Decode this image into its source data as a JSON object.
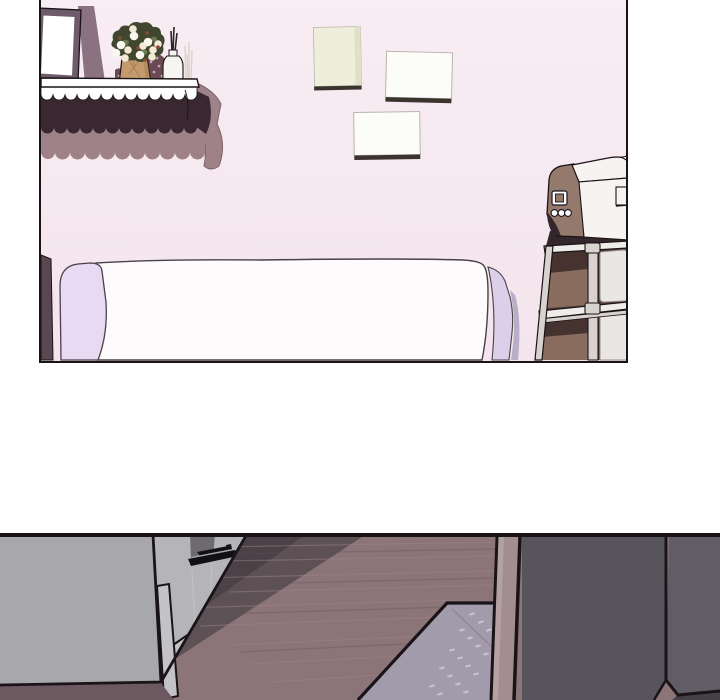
{
  "canvas": {
    "width": 720,
    "height": 700,
    "background": "#ffffff"
  },
  "scene": {
    "type": "webtoon-strip",
    "panel_count": 2,
    "panels": [
      {
        "name": "bedroom-with-shelf-bed-and-printer-cart"
      },
      {
        "name": "dim-room-with-cabinet-floor-and-mat"
      }
    ]
  },
  "palette": {
    "ink": "#1a1317",
    "wall": "#f8edf3",
    "wall_deep": "#f4e4ed",
    "frame_outer": "#6e5c6a",
    "frame_shadow": "#8a7280",
    "frame_canvas": "#ffffff",
    "canvas_cream": "#efeedb",
    "canvas_cream_shade": "#e0dfc8",
    "canvas_white": "#fcfcf9",
    "canvas_edge_dark": "#3a332e",
    "canvas_edge_gray": "#b9b4ae",
    "shelf_board": "#fefefe",
    "skirt_dark": "#3a2830",
    "skirt_mauve": "#9e8287",
    "skirt_mauve_dark": "#7c6169",
    "bag_tan": "#c49b6e",
    "bag_tan_dark": "#a87e52",
    "cloth_floral": "#6b4a56",
    "cloth_dot": "#c3abb5",
    "leaf_dark": "#41462f",
    "leaf_mid": "#6d7a4e",
    "flower_white": "#fbf7ee",
    "flower_cream": "#f3ead6",
    "flower_rust": "#8d4a35",
    "diffuser_white": "#f7f5f2",
    "reed_black": "#2a2326",
    "dry_stick": "#ddd2c6",
    "bed_white": "#fdfbfc",
    "bed_outline": "#4a4149",
    "pillow_lavender": "#e7daf2",
    "pillow_lavender2": "#dccfe9",
    "pillow_shadow": "#b9adc8",
    "bedside_dark": "#594751",
    "printer_white": "#f6f3f1",
    "printer_taupe": "#94796d",
    "printer_dark": "#33272b",
    "panel_btn_white": "#ffffff",
    "cart_metal": "#d8d3cf",
    "cart_metal_bright": "#efedea",
    "cart_back_dark": "#553f3a",
    "bin_brown": "#8a6c5e",
    "bin_brown_dark": "#46332f",
    "bin_white": "#e9e7e4",
    "bin_edge": "#9b9089",
    "cab_front": "#a8a8ac",
    "cab_side": "#b5b5b9",
    "cab_dark_patch": "#6d6a70",
    "cab_kick": "#c3c3c7",
    "handle_black": "#121014",
    "handle_hl": "#a3a3ab",
    "floor": "#8b7579",
    "floor_streak": "#9c8689",
    "shadow_dark": "#4b4147",
    "shadow_mid": "#5e5156",
    "shadow_under": "#6c585f",
    "mat": "#a29bab",
    "mat_line": "#8b8495",
    "mat_dash": "#d2ccdc",
    "pillar": "#a28e91",
    "pillar_hl": "#b5a3a5",
    "dark_face": "#57545b",
    "dark_face_right": "#605d64",
    "dark_face_below": "#454147"
  }
}
